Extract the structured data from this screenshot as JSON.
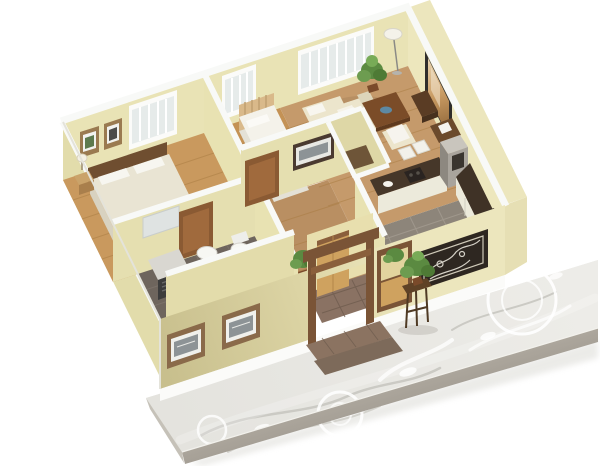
{
  "scene": {
    "type": "3d-isometric-floor-plan-render",
    "description": "Cutaway 3D render of a small house floor plan viewed from above, sitting on a gray decorative paved terrace slab on a white background",
    "background": "#ffffff"
  },
  "colors": {
    "background": "#ffffff",
    "wall_interior": "#e9e3b5",
    "wall_interior_shade": "#e2dcab",
    "wall_exterior_olive": "#c8bf8d",
    "wall_exterior_mid": "#dcd4a4",
    "wall_exterior_cream": "#ece6bd",
    "wall_cap": "#f8f9f7",
    "floor_wood": "#c9995e",
    "floor_wood_hall": "#b98f62",
    "floor_tile_dark": "#6e655d",
    "floor_tile_kitchen": "#8d857a",
    "floor_tile_entry": "#8a7263",
    "slab_top": "#e8e7e2",
    "slab_edge": "#a29c92",
    "slab_pattern": "#ffffff",
    "bed_duvet": "#e9e4d3",
    "bed_white": "#f4f2ea",
    "blanket_green": "#c7dcb4",
    "sofa_cream": "#ece5cc",
    "table_wood_dark": "#7b4c28",
    "trim_brown": "#7a5436",
    "door_brown": "#8a5a33",
    "door_tan": "#cfa25f",
    "tv_frame": "#2f2d2b",
    "tv_screen": "#c89a62",
    "appliance_dark": "#3f3226",
    "cabinet_white": "#eceadb",
    "plant_green": "#5b8a41",
    "fixture_white": "#f7f7f3",
    "frame_art": "#8d9396",
    "panel_dark": "#2e2721",
    "glass": "#e6ebea"
  },
  "rooms": [
    {
      "id": "master-bedroom",
      "floor": "wood",
      "items": [
        "double-bed",
        "pillows",
        "headboard",
        "nightstand",
        "table-lamp",
        "two-wall-frames",
        "double-window",
        "bathroom-door"
      ]
    },
    {
      "id": "small-bedroom",
      "floor": "wood",
      "items": [
        "single-bed",
        "green-blanket",
        "slat-headboard",
        "window"
      ]
    },
    {
      "id": "living-room",
      "floor": "wood",
      "items": [
        "window-bench",
        "round-stools",
        "sofa",
        "armchair",
        "coffee-table",
        "blue-bowl",
        "tv",
        "tv-stand",
        "media-desk",
        "floor-lamp",
        "potted-plant",
        "wide-window"
      ]
    },
    {
      "id": "kitchen",
      "floor": "gray-tile",
      "items": [
        "island-counter",
        "stove",
        "dining-chairs",
        "appliance-tower",
        "wall-cabinets",
        "shelf-unit"
      ]
    },
    {
      "id": "bathroom-main",
      "floor": "dark-tile",
      "items": [
        "washing-machine",
        "pedestal-sink",
        "toilet",
        "mirror-shelf",
        "brown-door"
      ]
    },
    {
      "id": "bathroom-second",
      "floor": "dark-tile",
      "items": [
        "toilet",
        "bidet"
      ]
    },
    {
      "id": "hallway",
      "floor": "wood",
      "items": [
        "wall-picture",
        "bedroom-door",
        "potted-plant",
        "closet-niche"
      ]
    },
    {
      "id": "entry-porch",
      "floor": "brown-tile",
      "items": [
        "entry-door",
        "portico-trim",
        "plant-niche",
        "side-panel",
        "steps"
      ]
    }
  ],
  "exterior": {
    "items": [
      "two-framed-pictures",
      "decorative-lattice-panel",
      "plant-stand",
      "paved-terrace",
      "floral-terrace-pattern"
    ]
  }
}
